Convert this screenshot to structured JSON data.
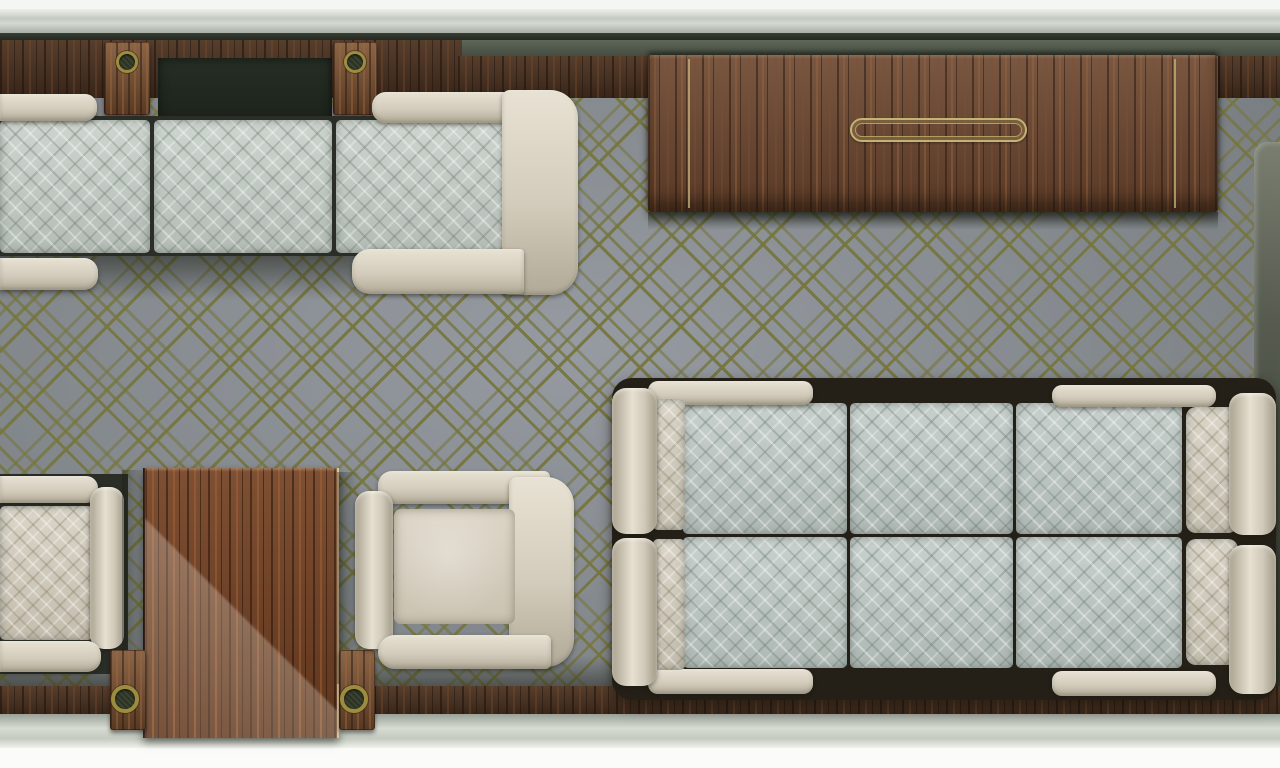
{
  "scene": {
    "label": "Top-down floor plan rendering of a luxury cabin lounge interior",
    "view": "plan-top-down"
  },
  "palette": {
    "outer_trim_white": "#f4f6f3",
    "metal_sill_band": "#c3cac1",
    "wall_wood_dark": "#4c3322",
    "credenza_wood": "#6a4630",
    "table_wood": "#6f3e21",
    "brass_inlay": "#c6b176",
    "grommet_brass": "#9d8c3f",
    "carpet_base": "#8e939a",
    "carpet_lattice_olive": "#767640",
    "cushion_sage": "#c6cec7",
    "cushion_blue_gray": "#bfc9c6",
    "upholstery_cream": "#d5cfc0",
    "shadow_dark": "#241f17"
  },
  "furniture": {
    "items": [
      {
        "name": "top-sofa-bench",
        "upholstery": "sage quilted cushions with cream trim",
        "seat_cushions": 3
      },
      {
        "name": "top-armchair",
        "upholstery": "cream arms with sage quilted seat"
      },
      {
        "name": "wall-credenza",
        "material": "walnut with brass inlay lines and recessed pull"
      },
      {
        "name": "bottom-left-bench-seat",
        "upholstery": "cream quilted"
      },
      {
        "name": "side-table",
        "material": "polished walnut"
      },
      {
        "name": "bottom-armchair",
        "upholstery": "cream"
      },
      {
        "name": "conference-sofa-group",
        "upholstery": "blue-gray quilted cushions with cream arm rolls",
        "seat_cushions": 6
      },
      {
        "name": "wall-grommet-tabs",
        "count": 4,
        "finish": "antique brass ring on walnut tab"
      }
    ]
  }
}
